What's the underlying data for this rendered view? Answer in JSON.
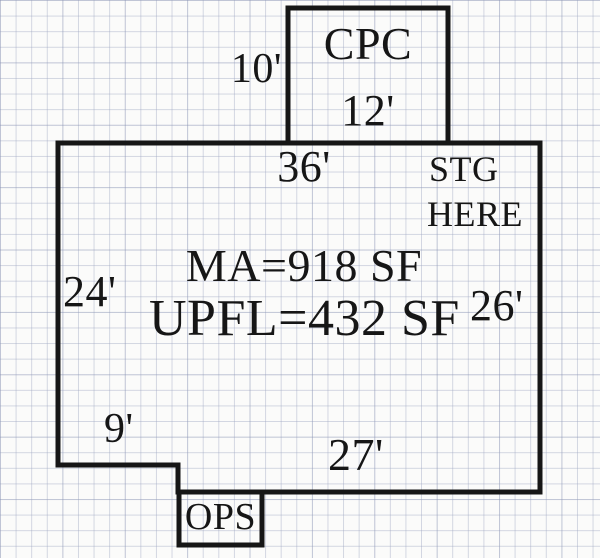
{
  "colors": {
    "ink": "#161616",
    "paper": "#fbfbfa"
  },
  "plan": {
    "cpc_room": {
      "name": "CPC",
      "width_dim": "12'",
      "height_dim": "10'"
    },
    "main_area": {
      "top_dim": "36'",
      "left_dim": "24'",
      "right_dim": "26'",
      "bottom_dim": "27'",
      "notch_dim": "9'",
      "area_main_floor": "MA=918 SF",
      "area_upper_floor": "UPFL=432 SF",
      "storage_note_line1": "STG",
      "storage_note_line2": "HERE"
    },
    "ops_room": {
      "name": "OPS"
    }
  }
}
